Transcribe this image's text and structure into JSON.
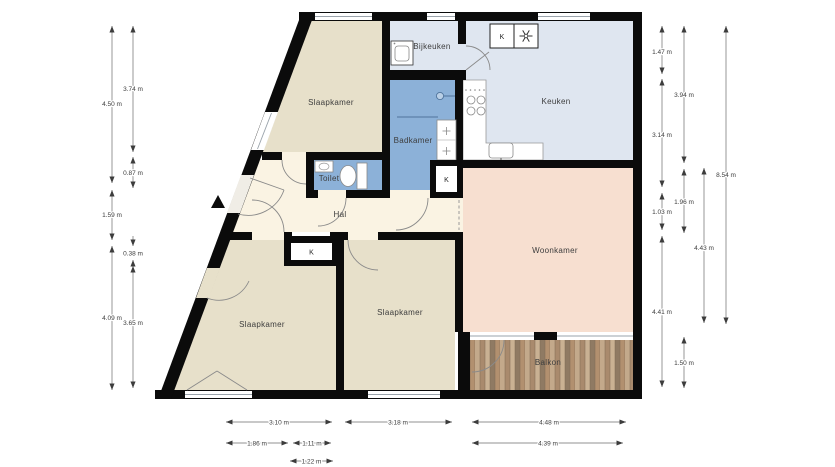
{
  "floorplan": {
    "rooms": {
      "slaapkamer_tl": "Slaapkamer",
      "bijkeuken": "Bijkeuken",
      "keuken": "Keuken",
      "badkamer": "Badkamer",
      "toilet": "Toilet",
      "hal": "Hal",
      "slaapkamer_bl": "Slaapkamer",
      "slaapkamer_bm": "Slaapkamer",
      "woonkamer": "Woonkamer",
      "balkon": "Balkon"
    },
    "closet_label": "K",
    "dimensions": {
      "left_outer": [
        "4.50 m",
        "1.59 m",
        "4.09 m"
      ],
      "left_inner": [
        "3.74 m",
        "0.87 m",
        "0.38 m",
        "3.65 m"
      ],
      "right_inner": [
        "1.47 m",
        "3.14 m",
        "1.03 m",
        "4.41 m"
      ],
      "right_middle": [
        "3.94 m",
        "1.96 m",
        "1.50 m"
      ],
      "right_outer": [
        "4.43 m"
      ],
      "right_total": [
        "8.54 m"
      ],
      "bottom_row1": [
        "3.10 m",
        "3.18 m",
        "4.48 m"
      ],
      "bottom_row2": [
        "1.86 m",
        "1.11 m",
        "4.39 m"
      ],
      "bottom_row3": [
        "1.22 m"
      ]
    },
    "colors": {
      "wall": "#0b0b0b",
      "bedroom": "#e7e0ca",
      "hall": "#faf3e3",
      "living": "#f7dfd0",
      "kitchen": "#dfe6f0",
      "bath": "#8cb1d8",
      "balcony_wood": "#b99878"
    }
  }
}
